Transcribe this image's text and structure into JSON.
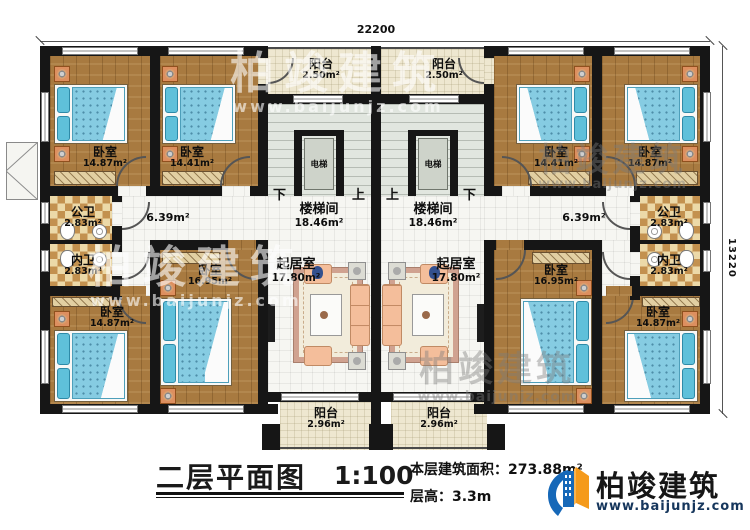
{
  "dimensions": {
    "top": "22200",
    "right": "13220"
  },
  "rooms": {
    "bedroom_tl_a": {
      "name": "卧室",
      "area": "14.87m²"
    },
    "bedroom_tl_b": {
      "name": "卧室",
      "area": "14.41m²"
    },
    "bedroom_tr_b": {
      "name": "卧室",
      "area": "14.41m²"
    },
    "bedroom_tr_a": {
      "name": "卧室",
      "area": "14.87m²"
    },
    "bedroom_bl_b": {
      "name": "卧室",
      "area": "16.95m²"
    },
    "bedroom_br_b": {
      "name": "卧室",
      "area": "16.95m²"
    },
    "bedroom_bl_a": {
      "name": "卧室",
      "area": "14.87m²"
    },
    "bedroom_br_a": {
      "name": "卧室",
      "area": "14.87m²"
    },
    "bath_pub_left": {
      "name": "公卫",
      "area": "2.83m²"
    },
    "bath_pub_right": {
      "name": "公卫",
      "area": "2.83m²"
    },
    "bath_priv_left": {
      "name": "内卫",
      "area": "2.83m²"
    },
    "bath_priv_right": {
      "name": "内卫",
      "area": "2.83m²"
    },
    "hall_left": {
      "area": "6.39m²"
    },
    "hall_right": {
      "area": "6.39m²"
    },
    "stair_left": {
      "name": "楼梯间",
      "area": "18.46m²"
    },
    "stair_right": {
      "name": "楼梯间",
      "area": "18.46m²"
    },
    "living_left": {
      "name": "起居室",
      "area": "17.80m²"
    },
    "living_right": {
      "name": "起居室",
      "area": "17.80m²"
    },
    "balcony_top_left": {
      "name": "阳台",
      "area": "2.50m²"
    },
    "balcony_top_right": {
      "name": "阳台",
      "area": "2.50m²"
    },
    "balcony_bottom_left": {
      "name": "阳台",
      "area": "2.96m²"
    },
    "balcony_bottom_right": {
      "name": "阳台",
      "area": "2.96m²"
    },
    "elevator": {
      "name": "电梯"
    }
  },
  "stair_marks": {
    "down": "下",
    "up": "上"
  },
  "title_block": {
    "title": "二层平面图",
    "scale": "1:100",
    "area_label": "本层建筑面积：",
    "area_value": "273.88m²",
    "floor_height_label": "层高：",
    "floor_height_value": "3.3m"
  },
  "brand": {
    "name": "柏竣建筑",
    "website": "www.baijunjz.com"
  },
  "watermark": {
    "name": "柏竣建筑",
    "website": "www.baijunjz.com"
  },
  "colors": {
    "wall": "#161616",
    "wood_floor": "#a87a40",
    "bed_blue": "#86cce2",
    "balcony": "#eee7d0",
    "checker_tan": "#c3914f",
    "brand_blue": "#1668b8",
    "brand_orange": "#f59a1b",
    "url_navy": "#16365c"
  }
}
